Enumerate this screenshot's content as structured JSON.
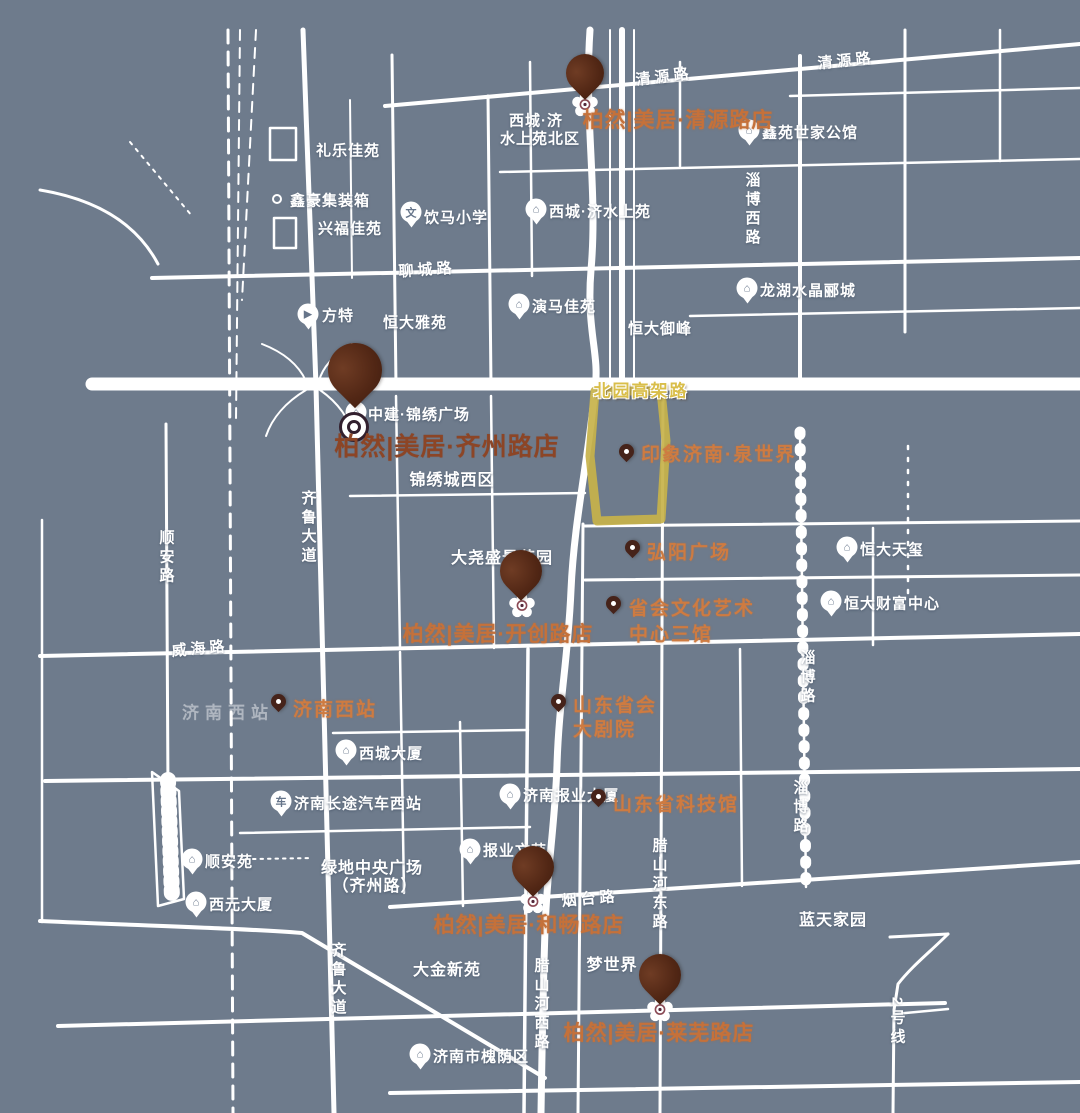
{
  "map": {
    "colors": {
      "background": "#6E7B8C",
      "road": "#FFFFFF",
      "brand_orange": "#C5713A",
      "brand_dark": "#8C4526",
      "pin_brown": "#4E2514",
      "highlight_yellow": "#C7B24A"
    },
    "highway_label": "北园高架路",
    "brand_stores": [
      {
        "label": "柏然|美居·清源路店"
      },
      {
        "label": "柏然|美居·齐州路店",
        "featured": true
      },
      {
        "label": "柏然|美居·开创路店"
      },
      {
        "label": "柏然|美居·和畅路店"
      },
      {
        "label": "柏然|美居·莱芜路店"
      }
    ],
    "orange_pois": [
      {
        "label": "印象济南·泉世界"
      },
      {
        "label": "弘阳广场"
      },
      {
        "lines": [
          "省会文化艺术",
          "中心三馆"
        ]
      },
      {
        "lines": [
          "山东省会",
          "大剧院"
        ]
      },
      {
        "label": "济南西站"
      },
      {
        "label": "山东省科技馆"
      }
    ],
    "white_pois": [
      {
        "label": "鑫苑世家公馆",
        "icon": "⌂"
      },
      {
        "label": "西城·济水上苑",
        "icon": "⌂"
      },
      {
        "label": "饮马小学",
        "icon": "文"
      },
      {
        "label": "龙湖水晶郦城",
        "icon": "⌂"
      },
      {
        "label": "演马佳苑",
        "icon": "⌂"
      },
      {
        "label": "方特",
        "icon": "▶"
      },
      {
        "label": "中建·锦绣广场",
        "icon": "⌂"
      },
      {
        "label": "恒大天玺",
        "icon": "⌂"
      },
      {
        "label": "恒大财富中心",
        "icon": "⌂"
      },
      {
        "label": "西城大厦",
        "icon": "⌂"
      },
      {
        "label": "济南长途汽车西站",
        "icon": "车"
      },
      {
        "label": "济南报业大厦",
        "icon": "⌂"
      },
      {
        "label": "报业文苑",
        "icon": "⌂"
      },
      {
        "label": "顺安苑",
        "icon": "⌂"
      },
      {
        "label": "西元大厦",
        "icon": "⌂"
      },
      {
        "label": "济南市槐荫区",
        "icon": "⌂"
      }
    ],
    "area_labels": [
      {
        "text": "西城·济"
      },
      {
        "text": "水上苑北区"
      },
      {
        "text": "礼乐佳苑"
      },
      {
        "text": "鑫豪集装箱"
      },
      {
        "text": "兴福佳苑"
      },
      {
        "text": "恒大雅苑"
      },
      {
        "text": "恒大御峰"
      },
      {
        "text": "锦绣城西区"
      },
      {
        "text": "大尧盛景花园"
      },
      {
        "text": "济南西站"
      },
      {
        "text": "绿地中央广场"
      },
      {
        "text": "（齐州路）"
      },
      {
        "text": "大金新苑"
      },
      {
        "text": "梦世界"
      },
      {
        "text": "蓝天家园"
      }
    ],
    "road_labels": [
      {
        "text": "清源路"
      },
      {
        "text": "清源路"
      },
      {
        "text": "聊城路"
      },
      {
        "text": "威海路"
      },
      {
        "text": "烟台路"
      },
      {
        "text": "淄博西路"
      },
      {
        "text": "淄博路"
      },
      {
        "text": "淄博路"
      },
      {
        "text": "顺安路"
      },
      {
        "text": "齐鲁大道"
      },
      {
        "text": "齐鲁大道"
      },
      {
        "text": "腊山河西路"
      },
      {
        "text": "腊山河东路"
      },
      {
        "text": "2号线"
      }
    ]
  }
}
